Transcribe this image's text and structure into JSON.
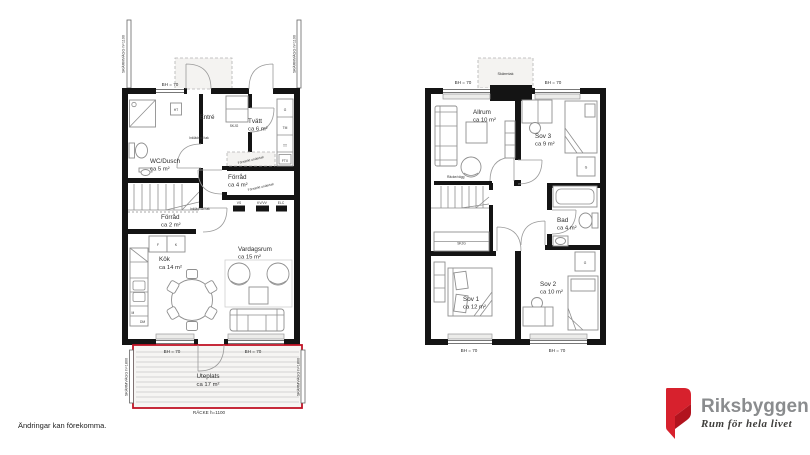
{
  "disclaimer": "Ändringar kan förekomma.",
  "logo": {
    "brand": "Riksbyggen",
    "tagline": "Rum för hela livet",
    "brand_color": "#8a8c8e",
    "red": "#d7212d",
    "red_dark": "#b2131e"
  },
  "colors": {
    "terrace_red": "#c11325",
    "wall_black": "#141414"
  },
  "labels": {
    "bh70": "BH = 70",
    "skarmvagg_h1100": "SKÄRMVÄGG h=1100",
    "skarmvagg_h1800": "SKÄRMVÄGG h=1800",
    "racke_h1100": "RÄCKE h=1100",
    "skarmtak": "Skärmtak",
    "inkladnad_tak": "Inklädnad tak",
    "forsankt_undertak": "Försänkt undertak",
    "racke_vagg": "Räcke/vägg",
    "skjg": "SKJG",
    "ht": "HT",
    "vs": "VS",
    "kv_vv": "KV/VV",
    "elc": "ELC",
    "ftx": "FTX",
    "tm": "TM",
    "tt": "TT",
    "g": "G",
    "f": "F",
    "k": "K",
    "m": "M",
    "dm": "DM"
  },
  "plan1": {
    "rooms": {
      "entre": {
        "name": "Entré"
      },
      "wc": {
        "name": "WC/Dusch",
        "area": "ca 5 m²"
      },
      "tvatt": {
        "name": "Tvätt",
        "area": "ca 6 m²"
      },
      "forrad4": {
        "name": "Förråd",
        "area": "ca 4 m²"
      },
      "forrad2": {
        "name": "Förråd",
        "area": "ca 2 m²"
      },
      "kok": {
        "name": "Kök",
        "area": "ca 14 m²"
      },
      "vardagsrum": {
        "name": "Vardagsrum",
        "area": "ca 15 m²"
      },
      "uteplats": {
        "name": "Uteplats",
        "area": "ca 17 m²"
      }
    }
  },
  "plan2": {
    "rooms": {
      "allrum": {
        "name": "Allrum",
        "area": "ca 10 m²"
      },
      "sov3": {
        "name": "Sov 3",
        "area": "ca 9 m²"
      },
      "bad": {
        "name": "Bad",
        "area": "ca 4 m²"
      },
      "sov1": {
        "name": "Sov 1",
        "area": "ca 12 m²"
      },
      "sov2": {
        "name": "Sov 2",
        "area": "ca 10 m²"
      }
    }
  }
}
